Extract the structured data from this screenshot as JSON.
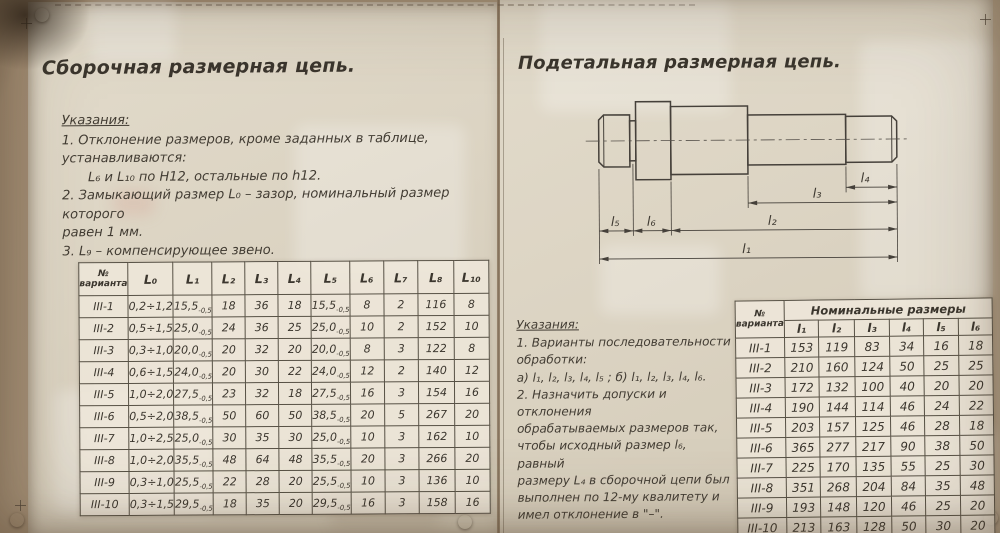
{
  "colors": {
    "ink": "#3d3831",
    "paper": "#dcd4c3",
    "wall": "#a08b72",
    "table_paper": "#eee8da"
  },
  "left": {
    "title": "Сборочная размерная цепь.",
    "notes_heading": "Указания:",
    "notes": [
      "1. Отклонение размеров, кроме заданных в таблице,",
      "устанавливаются:",
      "L₆ и L₁₀ по H12, остальные по h12.",
      "2. Замыкающий размер L₀ – зазор, номинальный размер которого",
      "равен 1 мм.",
      "3. L₉ – компенсирующее звено."
    ],
    "table": {
      "corner": {
        "line1": "№",
        "line2": "варианта"
      },
      "headers": [
        "L₀",
        "L₁",
        "L₂",
        "L₃",
        "L₄",
        "L₅",
        "L₆",
        "L₇",
        "L₈",
        "L₁₀"
      ],
      "rows": [
        [
          "III-1",
          "0,2÷1,2",
          "15,5~-0,5",
          "18",
          "36",
          "18",
          "15,5~-0,5",
          "8",
          "2",
          "116",
          "8"
        ],
        [
          "III-2",
          "0,5÷1,5",
          "25,0~-0,5",
          "24",
          "36",
          "25",
          "25,0~-0,5",
          "10",
          "2",
          "152",
          "10"
        ],
        [
          "III-3",
          "0,3÷1,0",
          "20,0~-0,5",
          "20",
          "32",
          "20",
          "20,0~-0,5",
          "8",
          "3",
          "122",
          "8"
        ],
        [
          "III-4",
          "0,6÷1,5",
          "24,0~-0,5",
          "20",
          "30",
          "22",
          "24,0~-0,5",
          "12",
          "2",
          "140",
          "12"
        ],
        [
          "III-5",
          "1,0÷2,0",
          "27,5~-0,5",
          "23",
          "32",
          "18",
          "27,5~-0,5",
          "16",
          "3",
          "154",
          "16"
        ],
        [
          "III-6",
          "0,5÷2,0",
          "38,5~-0,5",
          "50",
          "60",
          "50",
          "38,5~-0,5",
          "20",
          "5",
          "267",
          "20"
        ],
        [
          "III-7",
          "1,0÷2,5",
          "25,0~-0,5",
          "30",
          "35",
          "30",
          "25,0~-0,5",
          "10",
          "3",
          "162",
          "10"
        ],
        [
          "III-8",
          "1,0÷2,0",
          "35,5~-0,5",
          "48",
          "64",
          "48",
          "35,5~-0,5",
          "20",
          "3",
          "266",
          "20"
        ],
        [
          "III-9",
          "0,3÷1,0",
          "25,5~-0,5",
          "22",
          "28",
          "20",
          "25,5~-0,5",
          "10",
          "3",
          "136",
          "10"
        ],
        [
          "III-10",
          "0,3÷1,5",
          "29,5~-0,5",
          "18",
          "35",
          "20",
          "29,5~-0,5",
          "16",
          "3",
          "158",
          "16"
        ]
      ]
    }
  },
  "right": {
    "title": "Подетальная размерная цепь.",
    "notes_heading": "Указания:",
    "notes": [
      "1. Варианты последовательности",
      "обработки:",
      "а) l₁, l₂, l₃, l₄, l₅ ; б) l₁, l₂, l₃, l₄, l₆.",
      "2. Назначить допуски и отклонения",
      "обрабатываемых размеров так,",
      "чтобы исходный размер l₆, равный",
      "размеру L₄ в сборочной цепи был",
      "выполнен по 12-му квалитету и",
      "имел отклонение в \"–\"."
    ],
    "drawing": {
      "labels": [
        "l₁",
        "l₂",
        "l₃",
        "l₄",
        "l₅",
        "l₆"
      ]
    },
    "table": {
      "corner": {
        "line1": "№",
        "line2": "варианта"
      },
      "group_header": "Номинальные размеры",
      "headers": [
        "l₁",
        "l₂",
        "l₃",
        "l₄",
        "l₅",
        "l₆"
      ],
      "rows": [
        [
          "III-1",
          "153",
          "119",
          "83",
          "34",
          "16",
          "18"
        ],
        [
          "III-2",
          "210",
          "160",
          "124",
          "50",
          "25",
          "25"
        ],
        [
          "III-3",
          "172",
          "132",
          "100",
          "40",
          "20",
          "20"
        ],
        [
          "III-4",
          "190",
          "144",
          "114",
          "46",
          "24",
          "22"
        ],
        [
          "III-5",
          "203",
          "157",
          "125",
          "46",
          "28",
          "18"
        ],
        [
          "III-6",
          "365",
          "277",
          "217",
          "90",
          "38",
          "50"
        ],
        [
          "III-7",
          "225",
          "170",
          "135",
          "55",
          "25",
          "30"
        ],
        [
          "III-8",
          "351",
          "268",
          "204",
          "84",
          "35",
          "48"
        ],
        [
          "III-9",
          "193",
          "148",
          "120",
          "46",
          "25",
          "20"
        ],
        [
          "III-10",
          "213",
          "163",
          "128",
          "50",
          "30",
          "20"
        ]
      ]
    }
  }
}
